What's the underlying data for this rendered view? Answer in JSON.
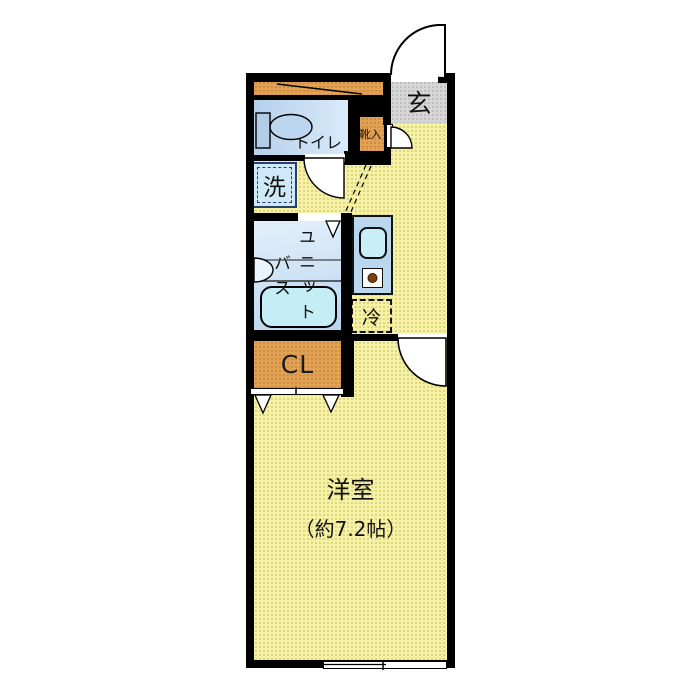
{
  "floorplan": {
    "rooms": {
      "entrance": "玄",
      "shoe_box": "靴入",
      "toilet": "トイレ",
      "washer": "洗",
      "bath_col_unit": "ユニット",
      "bath_col_bath": "バス",
      "refrigerator": "冷",
      "closet": "CL",
      "main_room": "洋室",
      "main_room_size": "（約7.2帖）"
    },
    "colors": {
      "wall": "#000000",
      "floor": "#f6f2a5",
      "floor-dot": "#ddd37d",
      "entrance-floor": "#d6d6d6",
      "closet-orange": "#e1a256",
      "water-blue": "#c3dcf2",
      "fixture-cyan": "#c5edf5",
      "kitchen-counter": "#b9d8f0",
      "washer-border": "#27406e",
      "burner-dot": "#7b3f10"
    }
  }
}
